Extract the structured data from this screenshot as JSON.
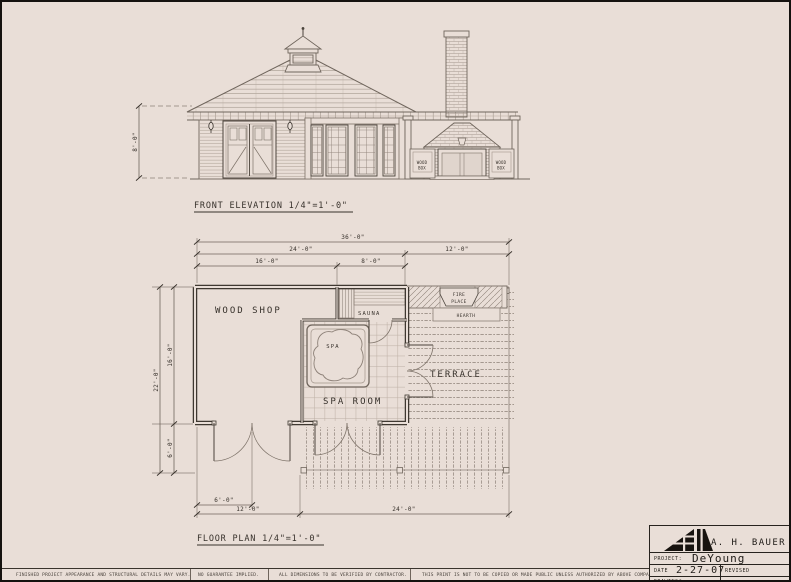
{
  "page": {
    "paper_color": "#e9ded7",
    "ink_dark": "#37312b",
    "ink_mid": "#6f655c",
    "ink_light": "#a2968c"
  },
  "front_elevation": {
    "title": "FRONT ELEVATION  1/4\"=1'-0\"",
    "height_dim": "8'-0\"",
    "wood_box_left": {
      "line1": "WOOD",
      "line2": "BOX"
    },
    "wood_box_right": {
      "line1": "WOOD",
      "line2": "BOX"
    }
  },
  "floor_plan": {
    "title": "FLOOR PLAN  1/4\"=1'-0\"",
    "rooms": {
      "wood_shop": "WOOD SHOP",
      "sauna": "SAUNA",
      "spa": "SPA",
      "spa_room": "SPA ROOM",
      "terrace": "TERRACE",
      "fireplace_line1": "FIRE",
      "fireplace_line2": "PLACE",
      "hearth": "HEARTH"
    },
    "dimensions": {
      "overall_width": "36'-0\"",
      "main_width": "24'-0\"",
      "terrace_width": "12'-0\"",
      "shop_width": "16'-0\"",
      "sauna_width": "8'-0\"",
      "overall_depth": "22'-0\"",
      "shop_depth": "16'-0\"",
      "porch_depth": "6'-0\"",
      "door_offset": "6'-0\"",
      "bottom_left_width": "12'-0\"",
      "bottom_right_width": "24'-0\""
    }
  },
  "title_block": {
    "company": "A. H. BAUER",
    "project_label": "PROJECT:",
    "project_value": "DeYoung",
    "date_label": "DATE",
    "date_value": "2-27-07",
    "revised_label": "REVISED",
    "drawing_label": "DRAWING*"
  },
  "footer": {
    "disclaimer_variance": "FINISHED PROJECT APPEARANCE AND STRUCTURAL DETAILS MAY VARY.",
    "disclaimer_guarantee": "NO GUARANTEE IMPLIED.",
    "disclaimer_dimensions": "ALL DIMENSIONS TO BE VERIFIED BY CONTRACTOR.",
    "disclaimer_copy": "THIS PRINT IS NOT TO BE COPIED OR MADE PUBLIC UNLESS AUTHORIZED BY ABOVE COMPANY."
  }
}
